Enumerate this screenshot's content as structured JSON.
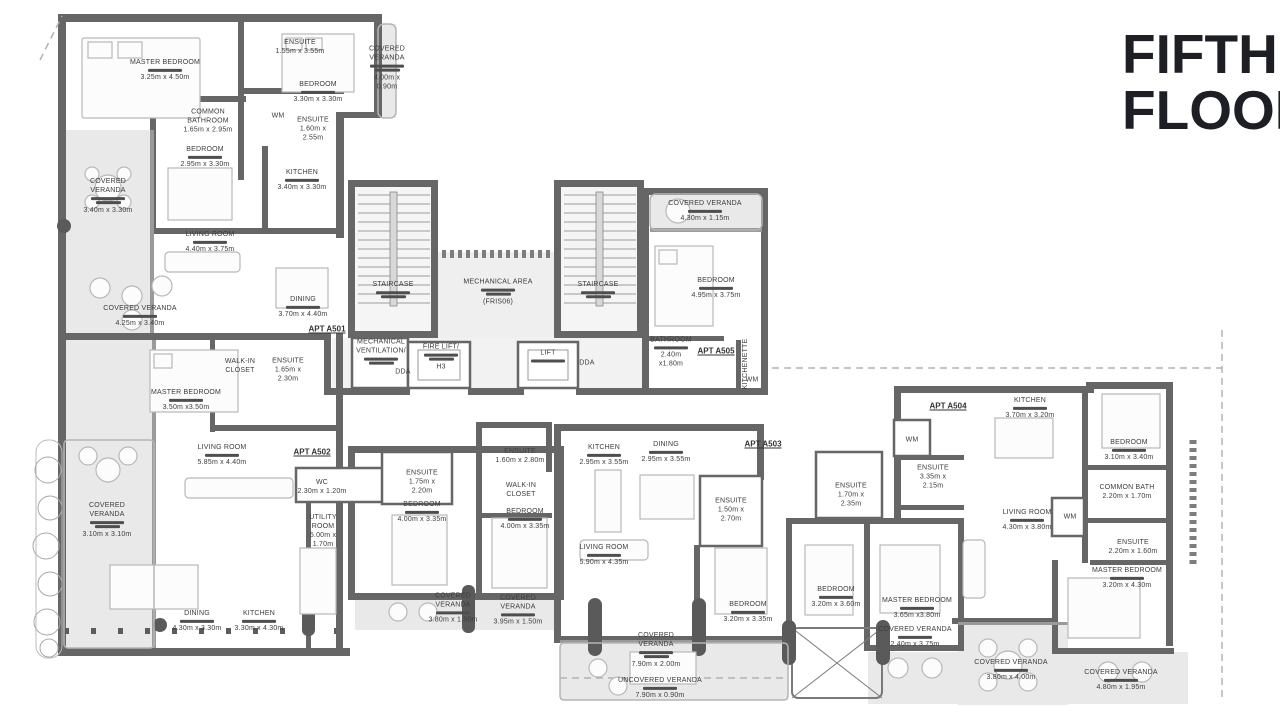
{
  "title": {
    "line1": "FIFTH",
    "line2": "FLOOR"
  },
  "colors": {
    "wall": "#666666",
    "label": "#3c3c3c",
    "veranda_fill": "#e9e9e9",
    "arabic_bar": "#4e4e4e"
  },
  "apartments": [
    {
      "label": "APT A501",
      "x": 327,
      "y": 329
    },
    {
      "label": "APT A502",
      "x": 312,
      "y": 452
    },
    {
      "label": "APT A503",
      "x": 763,
      "y": 444
    },
    {
      "label": "APT A504",
      "x": 948,
      "y": 406
    },
    {
      "label": "APT A505",
      "x": 716,
      "y": 351
    }
  ],
  "rooms": [
    {
      "n": "MASTER BEDROOM",
      "d": "3.25m x 4.50m",
      "x": 165,
      "y": 70,
      "ar": 1
    },
    {
      "n": "ENSUITE",
      "d": "1.55m x 3.55m",
      "x": 300,
      "y": 47,
      "ar": 0
    },
    {
      "n": "BEDROOM",
      "d": "3.30m x 3.30m",
      "x": 318,
      "y": 92,
      "ar": 1
    },
    {
      "n": "COVERED VERANDA",
      "d": "4.00m x 0.90m",
      "x": 387,
      "y": 68,
      "ar": 2,
      "w": 42
    },
    {
      "n": "COMMON BATHROOM",
      "d": "1.65m x 2.95m",
      "x": 208,
      "y": 121,
      "ar": 0,
      "w": 56
    },
    {
      "n": "WM",
      "d": "",
      "x": 278,
      "y": 116,
      "ar": 0,
      "w": 20
    },
    {
      "n": "ENSUITE",
      "d": "1.60m x 2.55m",
      "x": 313,
      "y": 129,
      "ar": 0,
      "w": 40
    },
    {
      "n": "BEDROOM",
      "d": "2.95m x 3.30m",
      "x": 205,
      "y": 157,
      "ar": 1
    },
    {
      "n": "KITCHEN",
      "d": "3.40m x 3.30m",
      "x": 302,
      "y": 180,
      "ar": 1
    },
    {
      "n": "COVERED VERANDA",
      "d": "3.40m x 3.30m",
      "x": 108,
      "y": 196,
      "ar": 2,
      "w": 52
    },
    {
      "n": "LIVING ROOM",
      "d": "4.40m x 3.75m",
      "x": 210,
      "y": 242,
      "ar": 1
    },
    {
      "n": "COVERED VERANDA",
      "d": "4.25m x 3.40m",
      "x": 140,
      "y": 316,
      "ar": 1,
      "w": 110
    },
    {
      "n": "DINING",
      "d": "3.70m x 4.40m",
      "x": 303,
      "y": 307,
      "ar": 1
    },
    {
      "n": "STAIRCASE",
      "d": "",
      "x": 393,
      "y": 290,
      "ar": 2
    },
    {
      "n": "MECHANICAL AREA",
      "d": "(FRIS06)",
      "x": 498,
      "y": 292,
      "ar": 2,
      "w": 90
    },
    {
      "n": "STAIRCASE",
      "d": "",
      "x": 598,
      "y": 290,
      "ar": 2
    },
    {
      "n": "MECHANICAL VENTILATION/",
      "d": "",
      "x": 381,
      "y": 352,
      "ar": 2,
      "w": 52
    },
    {
      "n": "DDA",
      "d": "",
      "x": 403,
      "y": 372,
      "ar": 0,
      "w": 24
    },
    {
      "n": "FIRE LIFT/",
      "d": "H3",
      "x": 441,
      "y": 357,
      "ar": 2,
      "w": 50
    },
    {
      "n": "LIFT",
      "d": "",
      "x": 548,
      "y": 356,
      "ar": 1,
      "w": 44
    },
    {
      "n": "DDA",
      "d": "",
      "x": 587,
      "y": 363,
      "ar": 0,
      "w": 24
    },
    {
      "n": "COVERED VERANDA",
      "d": "4.30m x 1.15m",
      "x": 705,
      "y": 211,
      "ar": 1,
      "w": 110
    },
    {
      "n": "BEDROOM",
      "d": "4.95m x 3.75m",
      "x": 716,
      "y": 288,
      "ar": 1
    },
    {
      "n": "BATHROOM",
      "d": "2.40m x1.80m",
      "x": 671,
      "y": 352,
      "ar": 1,
      "w": 44
    },
    {
      "n": "KITCHENETTE",
      "d": "",
      "x": 747,
      "y": 364,
      "ar": 0,
      "rot": 1
    },
    {
      "n": "WM",
      "d": "",
      "x": 752,
      "y": 380,
      "ar": 0,
      "w": 20
    },
    {
      "n": "MASTER BEDROOM",
      "d": "3.50m x3.50m",
      "x": 186,
      "y": 400,
      "ar": 1
    },
    {
      "n": "WALK-IN CLOSET",
      "d": "",
      "x": 240,
      "y": 366,
      "ar": 0,
      "w": 40
    },
    {
      "n": "ENSUITE",
      "d": "1.65m x 2.30m",
      "x": 288,
      "y": 370,
      "ar": 0,
      "w": 40
    },
    {
      "n": "LIVING ROOM",
      "d": "5.85m x 4.40m",
      "x": 222,
      "y": 455,
      "ar": 1
    },
    {
      "n": "WC",
      "d": "2.30m x 1.20m",
      "x": 322,
      "y": 487,
      "ar": 0,
      "w": 56
    },
    {
      "n": "UTILITY ROOM",
      "d": "5.00m x 1.70m",
      "x": 323,
      "y": 531,
      "ar": 0,
      "w": 40
    },
    {
      "n": "DINING",
      "d": "4.30m x 3.30m",
      "x": 197,
      "y": 621,
      "ar": 1
    },
    {
      "n": "KITCHEN",
      "d": "3.30m x 4.30m",
      "x": 259,
      "y": 621,
      "ar": 1
    },
    {
      "n": "COVERED VERANDA",
      "d": "3.10m x 3.10m",
      "x": 107,
      "y": 520,
      "ar": 2,
      "w": 52
    },
    {
      "n": "ENSUITE",
      "d": "1.75m x 2.20m",
      "x": 422,
      "y": 482,
      "ar": 0,
      "w": 44
    },
    {
      "n": "BEDROOM",
      "d": "4.00m x 3.35m",
      "x": 422,
      "y": 512,
      "ar": 1
    },
    {
      "n": "ENSUITE",
      "d": "1.60m x 2.80m",
      "x": 520,
      "y": 456,
      "ar": 0,
      "w": 50
    },
    {
      "n": "WALK-IN CLOSET",
      "d": "",
      "x": 521,
      "y": 490,
      "ar": 0,
      "w": 40
    },
    {
      "n": "BEDROOM",
      "d": "4.00m x 3.35m",
      "x": 525,
      "y": 519,
      "ar": 1,
      "w": 60
    },
    {
      "n": "COVERED VERANDA",
      "d": "3.80m x 1.50m",
      "x": 453,
      "y": 608,
      "ar": 1,
      "w": 62
    },
    {
      "n": "COVERED VERANDA",
      "d": "3.95m x 1.50m",
      "x": 518,
      "y": 610,
      "ar": 1,
      "w": 62
    },
    {
      "n": "KITCHEN",
      "d": "2.95m x 3.55m",
      "x": 604,
      "y": 455,
      "ar": 1
    },
    {
      "n": "DINING",
      "d": "2.95m x 3.55m",
      "x": 666,
      "y": 452,
      "ar": 1
    },
    {
      "n": "ENSUITE",
      "d": "1.50m x 2.70m",
      "x": 731,
      "y": 510,
      "ar": 0,
      "w": 40
    },
    {
      "n": "LIVING ROOM",
      "d": "5.90m x 4.35m",
      "x": 604,
      "y": 555,
      "ar": 1
    },
    {
      "n": "BEDROOM",
      "d": "3.20m x 3.35m",
      "x": 748,
      "y": 612,
      "ar": 1
    },
    {
      "n": "ENSUITE",
      "d": "1.70m x 2.35m",
      "x": 851,
      "y": 495,
      "ar": 0,
      "w": 40
    },
    {
      "n": "BEDROOM",
      "d": "3.20m x 3.60m",
      "x": 836,
      "y": 597,
      "ar": 1
    },
    {
      "n": "COVERED VERANDA",
      "d": "7.90m x 2.00m",
      "x": 656,
      "y": 650,
      "ar": 2,
      "w": 52
    },
    {
      "n": "UNCOVERED VERANDA",
      "d": "7.90m x 0.90m",
      "x": 660,
      "y": 688,
      "ar": 1,
      "w": 120
    },
    {
      "n": "KITCHEN",
      "d": "3.70m x 3.20m",
      "x": 1030,
      "y": 408,
      "ar": 1
    },
    {
      "n": "WM",
      "d": "",
      "x": 912,
      "y": 440,
      "ar": 0,
      "w": 20
    },
    {
      "n": "ENSUITE",
      "d": "3.35m x 2.15m",
      "x": 933,
      "y": 477,
      "ar": 0,
      "w": 40
    },
    {
      "n": "LIVING ROOM",
      "d": "4.30m x 3.80m",
      "x": 1027,
      "y": 520,
      "ar": 1
    },
    {
      "n": "WM",
      "d": "",
      "x": 1070,
      "y": 517,
      "ar": 0,
      "w": 20
    },
    {
      "n": "BEDROOM",
      "d": "3.10m x 3.40m",
      "x": 1129,
      "y": 450,
      "ar": 1
    },
    {
      "n": "COMMON BATH",
      "d": "2.20m x 1.70m",
      "x": 1127,
      "y": 492,
      "ar": 0,
      "w": 70
    },
    {
      "n": "ENSUITE",
      "d": "2.20m x 1.60m",
      "x": 1133,
      "y": 547,
      "ar": 0,
      "w": 50
    },
    {
      "n": "MASTER BEDROOM",
      "d": "3.20m x 4.30m",
      "x": 1127,
      "y": 578,
      "ar": 1
    },
    {
      "n": "MASTER BEDROOM",
      "d": "3.65m x3.80m",
      "x": 917,
      "y": 608,
      "ar": 1
    },
    {
      "n": "COVERED VERANDA",
      "d": "2.40m x 3.75m",
      "x": 915,
      "y": 637,
      "ar": 1,
      "w": 110
    },
    {
      "n": "COVERED VERANDA",
      "d": "3.80m x 4.00m",
      "x": 1011,
      "y": 670,
      "ar": 1,
      "w": 110
    },
    {
      "n": "COVERED VERANDA",
      "d": "4.80m x 1.95m",
      "x": 1121,
      "y": 680,
      "ar": 1,
      "w": 110
    }
  ]
}
